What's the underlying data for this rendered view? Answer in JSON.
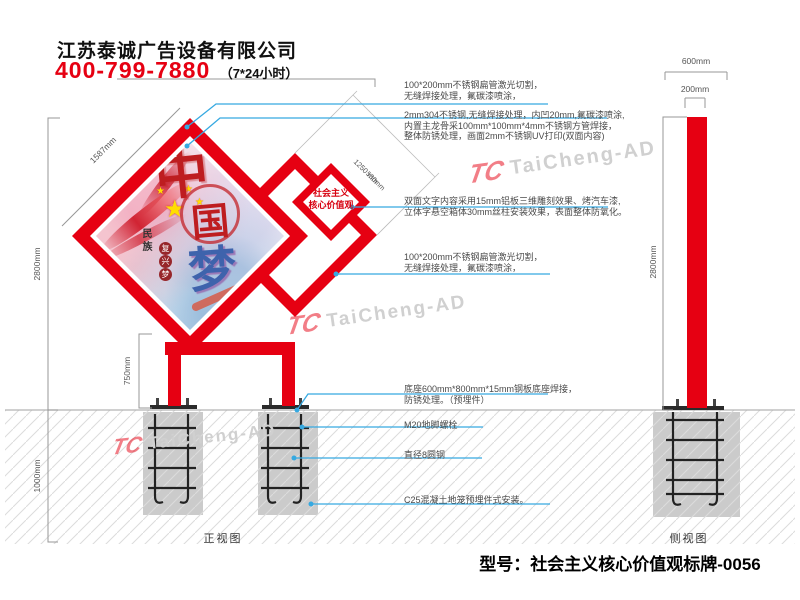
{
  "header": {
    "company": "江苏泰诚广告设备有限公司",
    "phone": "400-799-7880",
    "hours": "（7*24小时）"
  },
  "annotations": {
    "a1": [
      "100*200mm不锈钢扁管激光切割，",
      "无缝焊接处理，氟碳漆喷涂，"
    ],
    "a2": [
      "2mm304不锈钢,无缝焊接处理，内凹20mm,氟碳漆喷涂,",
      "内置主龙骨采100mm*100mm*4mm不锈钢方管焊接，",
      "整体防锈处理，画面2mm不锈钢UV打印(双面内容)"
    ],
    "a3": [
      "双面文字内容采用15mm铝板三维雕刻效果、烤汽车漆,",
      "立体字悬空箱体30mm丝柱安装效果，表面整体防氧化。"
    ],
    "a4": [
      "100*200mm不锈钢扁管激光切割，",
      "无缝焊接处理，氟碳漆喷涂，"
    ],
    "a5": [
      "底座600mm*800mm*15mm钢板底座焊接，",
      "防锈处理。（预埋件）"
    ],
    "a6": "M20地脚螺栓",
    "a7": "直径8圆钢",
    "a8": "C25混凝土地笼预埋件式安装。"
  },
  "dimensions": {
    "panel_edge": "1587mm",
    "height_above_ground": "2800mm",
    "underground_depth": "1000mm",
    "leg_height": "750mm",
    "mid_panel_edge": "1250 mm",
    "small_panel_edge": "530mm",
    "side_base_width": "600mm",
    "side_column_width": "200mm",
    "side_height": "2800mm"
  },
  "views": {
    "front": "正视图",
    "side": "侧视图"
  },
  "small_sign": {
    "line1": "社会主义",
    "line2": "核心价值观"
  },
  "artwork": {
    "char_top": "中",
    "char_mid": "国",
    "char_bottom": "梦",
    "vertical_text": "民族",
    "seal_chars": [
      "复",
      "兴",
      "梦"
    ],
    "star": "★"
  },
  "watermark": {
    "logo": "TC",
    "text": "TaiCheng-AD"
  },
  "footer": {
    "model": "型号：社会主义核心价值观标牌-0056"
  },
  "colors": {
    "brand_red": "#E60012",
    "leader_blue": "#36A9E1",
    "dimension_grey": "#999999",
    "concrete_grey": "#CBCBCB",
    "rebar_black": "#222222",
    "watermark_grey": "#D0D0D0"
  }
}
